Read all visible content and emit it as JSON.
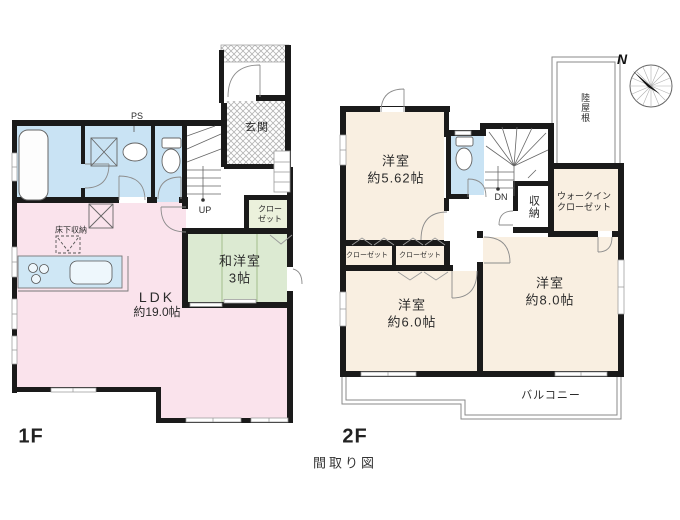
{
  "title": "間取り図",
  "compass": {
    "north": "N"
  },
  "colors": {
    "wall": "#1a1a1a",
    "room_pink": "#fae3ec",
    "room_blue": "#c9e3f4",
    "room_green": "#dcead2",
    "room_cream": "#f9efe1",
    "closet_green": "#ebf1dc",
    "counter_blue": "#cfe7f5"
  },
  "floor1": {
    "label": "1F",
    "entrance": "玄関",
    "pipe_space": "PS",
    "stairs_up": "UP",
    "closet_line1": "クロー",
    "closet_line2": "ゼット",
    "underfloor_storage": "床下収納",
    "ldk": {
      "name": "LDK",
      "size": "約19.0帖"
    },
    "japanese_room": {
      "name": "和洋室",
      "size": "3帖"
    }
  },
  "floor2": {
    "label": "2F",
    "stairs_down": "DN",
    "bedroom_small": {
      "name": "洋室",
      "size": "約5.62帖"
    },
    "bedroom_mid": {
      "name": "洋室",
      "size": "約6.0帖"
    },
    "bedroom_large": {
      "name": "洋室",
      "size": "約8.0帖"
    },
    "walk_in_closet_line1": "ウォークイン",
    "walk_in_closet_line2": "クローゼット",
    "storage": "収納",
    "closet_left": "クローゼット",
    "closet_right": "クローゼット",
    "balcony": "バルコニー",
    "flat_roof": "陸屋根"
  }
}
